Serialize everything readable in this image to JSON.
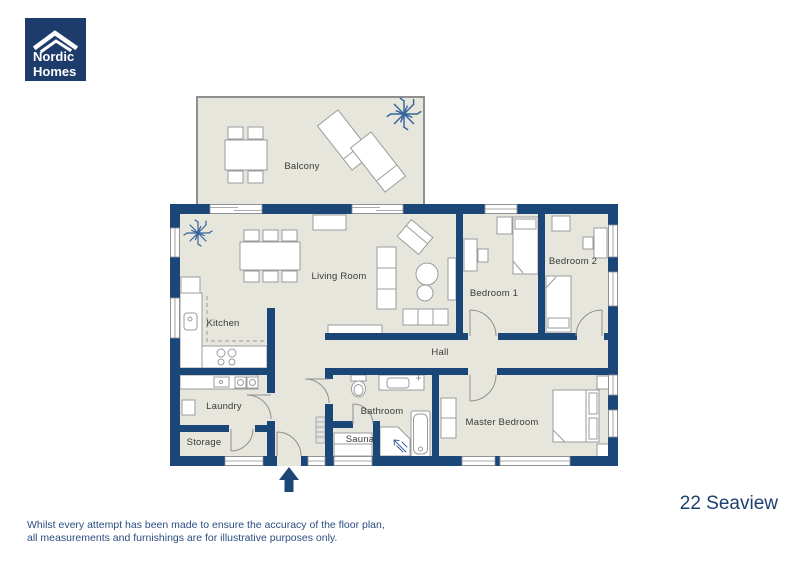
{
  "logo": {
    "line1": "Nordic",
    "line2": "Homes"
  },
  "rooms": {
    "balcony": "Balcony",
    "living_room": "Living Room",
    "kitchen": "Kitchen",
    "laundry": "Laundry",
    "storage": "Storage",
    "bathroom": "Bathroom",
    "sauna": "Sauna",
    "hall": "Hall",
    "bedroom1": "Bedroom 1",
    "bedroom2": "Bedroom 2",
    "master_bedroom": "Master Bedroom"
  },
  "plan_title": "22 Seaview",
  "disclaimer": {
    "line1": "Whilst every attempt has been made to ensure the accuracy of the floor plan,",
    "line2": "all measurements and furnishings are for illustrative purposes only."
  },
  "colors": {
    "wall": "#1b4778",
    "floor": "#e7e6dc",
    "logo_bg": "#1e3c6b",
    "title_text": "#1d3f6e",
    "disclaimer_text": "#2b4d80",
    "plant": "#35639c",
    "furniture_stroke": "#9b9b9b"
  }
}
